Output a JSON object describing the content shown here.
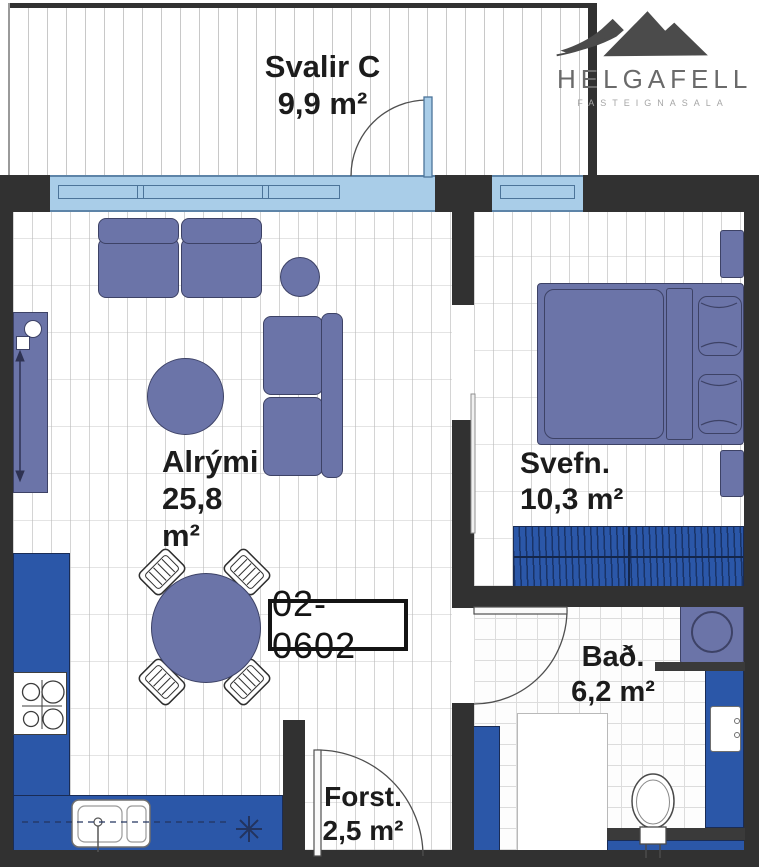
{
  "unit": {
    "label": "02-0602"
  },
  "logo": {
    "title": "HELGAFELL",
    "subtitle": "FASTEIGNASALA",
    "mark": "mountains-icon"
  },
  "rooms": {
    "balcony": {
      "name": "Svalir C",
      "area": "9,9 m²"
    },
    "living": {
      "name": "Alrými",
      "area_value": "25,8",
      "area_unit": "m²"
    },
    "bedroom": {
      "name": "Svefn.",
      "area": "10,3 m²"
    },
    "bathroom": {
      "name": "Bað.",
      "area": "6,2 m²"
    },
    "hall": {
      "name": "Forst.",
      "area": "2,5 m²"
    }
  },
  "colors": {
    "wall": "#313131",
    "window_glass": "#a9cde8",
    "furniture": "#6b74a8",
    "cabinet_blue": "#2b57a8",
    "text": "#1c1c1c",
    "logo_gray": "#6a6a6a"
  },
  "icons": {
    "mountains-icon": "mountain-silhouette",
    "toilet-icon": "toilet-top-view",
    "stove-icon": "four-burner-cooktop",
    "sink-icon": "kitchen-sink-top-view",
    "light-icon": "eight-point-star"
  }
}
